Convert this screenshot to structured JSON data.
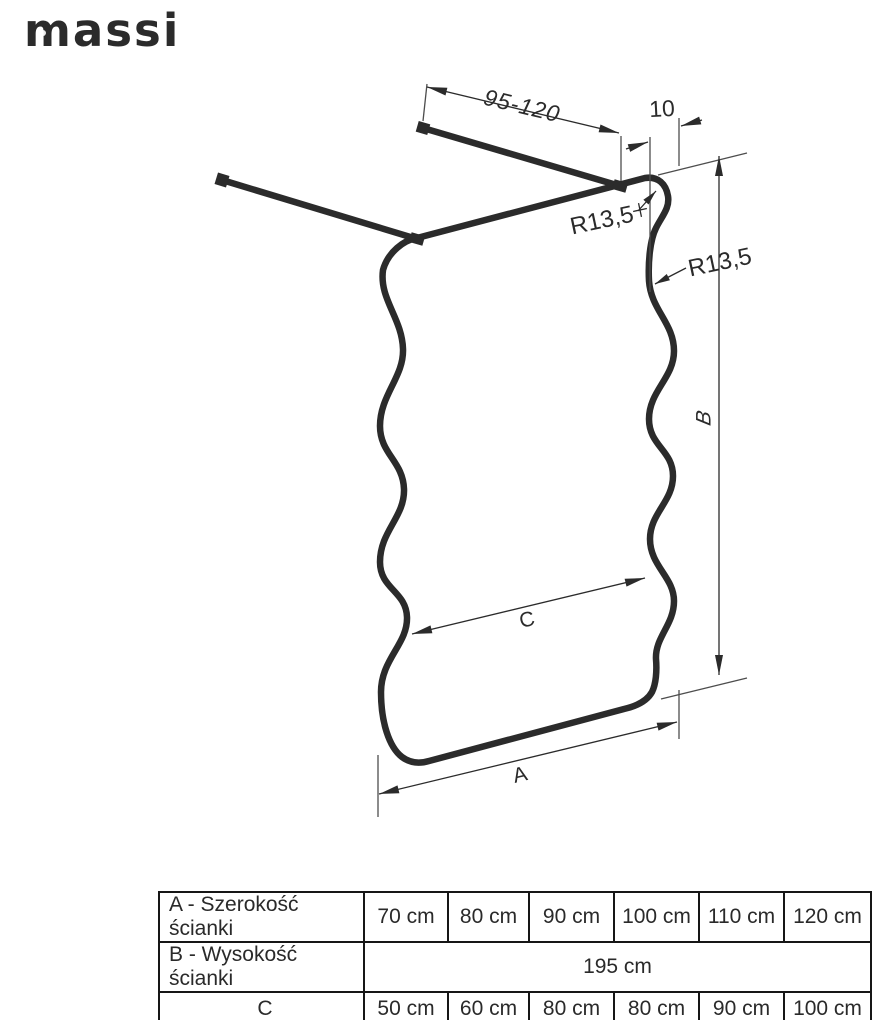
{
  "logo": {
    "text": "massi"
  },
  "diagram": {
    "labels": {
      "bar_length_range": "95-120",
      "top_offset": "10",
      "corner_radius": "R13,5",
      "wave_radius": "R13,5",
      "height": "B",
      "waist_width": "C",
      "width": "A"
    },
    "colors": {
      "stroke": "#2b2b2b",
      "thin_stroke": "#4d4d4d",
      "background": "#ffffff"
    }
  },
  "table": {
    "rows": [
      {
        "label": "A - Szerokość ścianki",
        "values": [
          "70 cm",
          "80 cm",
          "90 cm",
          "100 cm",
          "110 cm",
          "120 cm"
        ]
      },
      {
        "label": "B - Wysokość ścianki",
        "merged_value": "195 cm"
      },
      {
        "label": "C",
        "values": [
          "50 cm",
          "60 cm",
          "80 cm",
          "80 cm",
          "90 cm",
          "100 cm"
        ]
      }
    ]
  }
}
